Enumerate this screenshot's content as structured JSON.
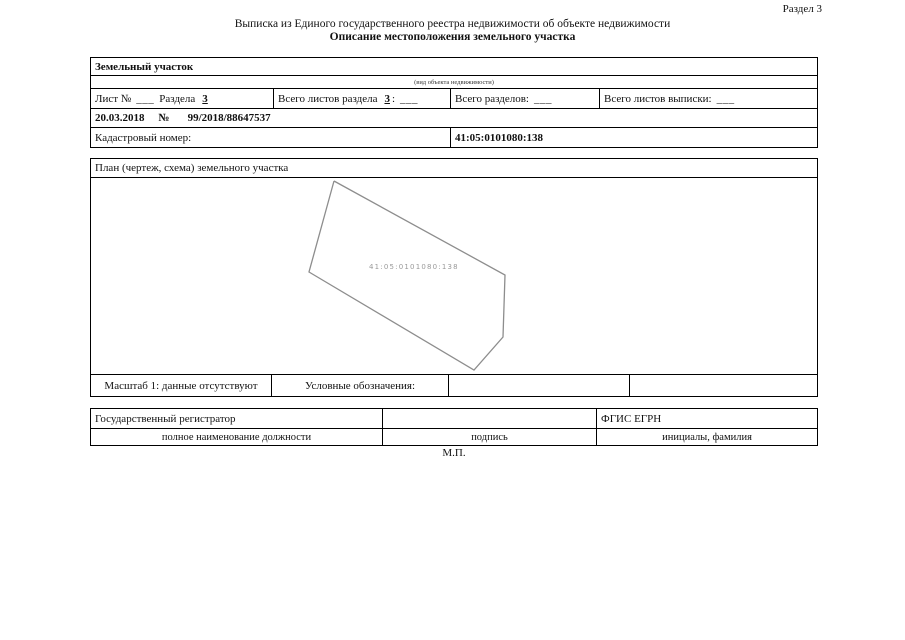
{
  "page": {
    "section_label": "Раздел 3",
    "title_line1": "Выписка из Единого государственного реестра недвижимости об объекте недвижимости",
    "title_line2": "Описание местоположения земельного участка",
    "stamp": "М.П."
  },
  "object_table": {
    "object_type": "Земельный участок",
    "object_type_caption": "(вид объекта недвижимости)",
    "sheet_cell": {
      "label": "Лист №",
      "blank": "___",
      "section_label": "Раздела",
      "section_value": "3"
    },
    "sheets_total_cell": {
      "label": "Всего листов раздела",
      "value": "3",
      "colon": ":",
      "blank": "___"
    },
    "sections_total_cell": {
      "label": "Всего разделов:",
      "blank": "___"
    },
    "extract_sheets_cell": {
      "label": "Всего листов выписки:",
      "blank": "___"
    },
    "date_row": {
      "date": "20.03.2018",
      "no_sign": "№",
      "number": "99/2018/88647537"
    },
    "cadastral_label": "Кадастровый номер:",
    "cadastral_value": "41:05:0101080:138"
  },
  "plan_table": {
    "title": "План (чертеж, схема) земельного участка",
    "parcel_label": "41:05:0101080:138",
    "polygon_points": "243,3 414,97 412,159 383,192 218,94 243,3",
    "scale_label": "Масштаб 1: данные отсутствуют",
    "legend_label": "Условные обозначения:"
  },
  "registrar_table": {
    "registrar_label": "Государственный регистратор",
    "system_label": "ФГИС ЕГРН",
    "position_caption": "полное наименование должности",
    "signature_caption": "подпись",
    "initials_caption": "инициалы, фамилия"
  }
}
